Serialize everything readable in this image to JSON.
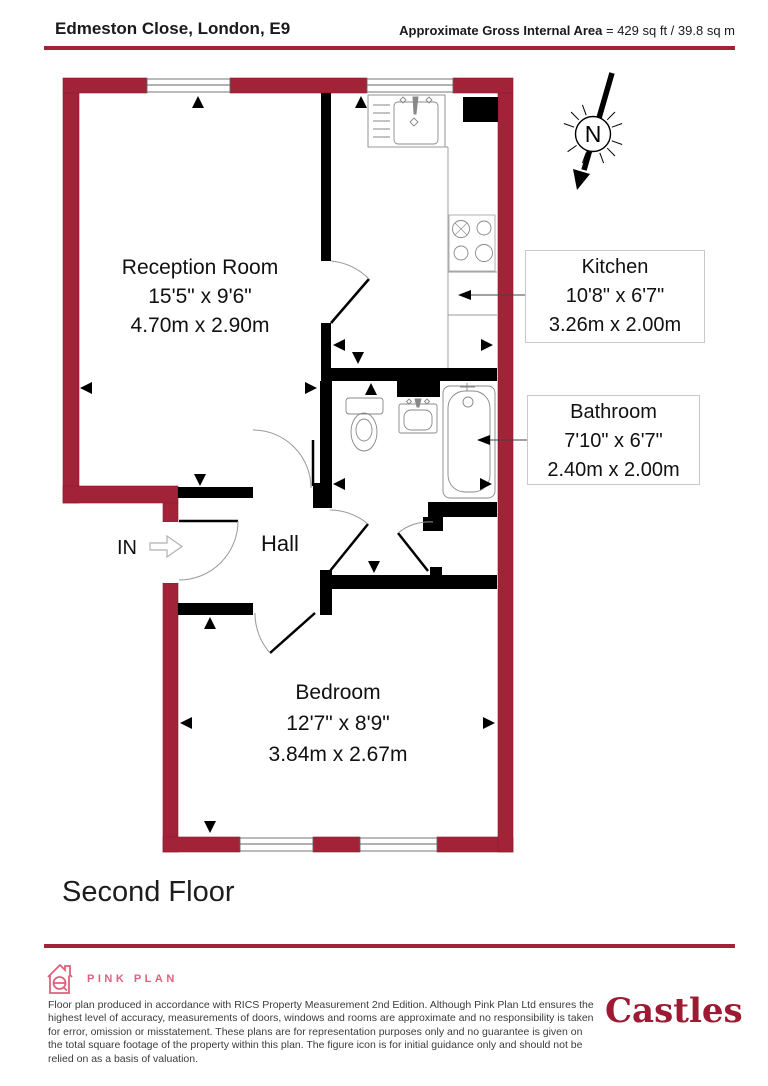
{
  "header": {
    "address": "Edmeston Close, London, E9",
    "area_label": "Approximate Gross Internal Area",
    "area_value": "= 429 sq ft / 39.8 sq m"
  },
  "floor_title": "Second Floor",
  "compass": {
    "north_label": "N"
  },
  "entrance": {
    "label": "IN"
  },
  "rooms": {
    "reception": {
      "name": "Reception Room",
      "imperial": "15'5\" x 9'6\"",
      "metric": "4.70m x 2.90m"
    },
    "kitchen": {
      "name": "Kitchen",
      "imperial": "10'8\" x 6'7\"",
      "metric": "3.26m x 2.00m"
    },
    "bathroom": {
      "name": "Bathroom",
      "imperial": "7'10\" x 6'7\"",
      "metric": "2.40m x 2.00m"
    },
    "hall": {
      "name": "Hall"
    },
    "bedroom": {
      "name": "Bedroom",
      "imperial": "12'7\" x 8'9\"",
      "metric": "3.84m x 2.67m"
    }
  },
  "footer": {
    "producer": "PINK PLAN",
    "disclaimer": "Floor plan produced in accordance with RICS Property Measurement 2nd Edition. Although Pink Plan Ltd ensures the highest level of accuracy, measurements of doors, windows and rooms are approximate and no responsibility is taken for error, omission or misstatement. These plans are for representation purposes only and no guarantee is given on the total square footage of the property within this plan. The figure icon is for initial guidance only and should not be relied on as a basis of valuation.",
    "brand": "Castles"
  },
  "colors": {
    "wall_red": "#a22237",
    "accent_pink": "#e0607c",
    "brand_red": "#9c1b32"
  }
}
